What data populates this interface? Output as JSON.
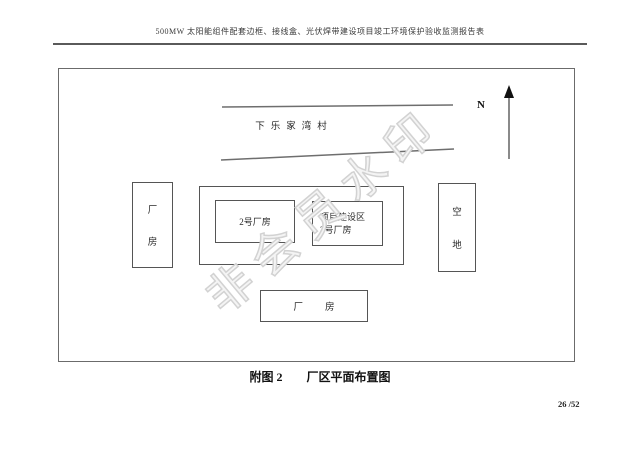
{
  "page": {
    "header_title": "500MW 太阳能组件配套边框、接线盒、光伏焊带建设项目竣工环境保护验收监测报告表",
    "caption_label": "附图 2",
    "caption_title": "厂区平面布置图",
    "page_number": "26 /52"
  },
  "diagram": {
    "north_label": "N",
    "village_label": "下乐家湾村",
    "left_building": {
      "char1": "厂",
      "char2": "房"
    },
    "building2_label": "2号厂房",
    "project_area": {
      "line1": "项目建设区",
      "line2": "3号厂房"
    },
    "empty_land": {
      "char1": "空",
      "char2": "地"
    },
    "bottom_building": {
      "char1": "厂",
      "char2": "房"
    }
  },
  "watermark": {
    "text": "非会员水印",
    "color": "#d2d2d2"
  },
  "colors": {
    "line": "#555555",
    "frame": "#6b6b6b",
    "background": "#ffffff"
  }
}
